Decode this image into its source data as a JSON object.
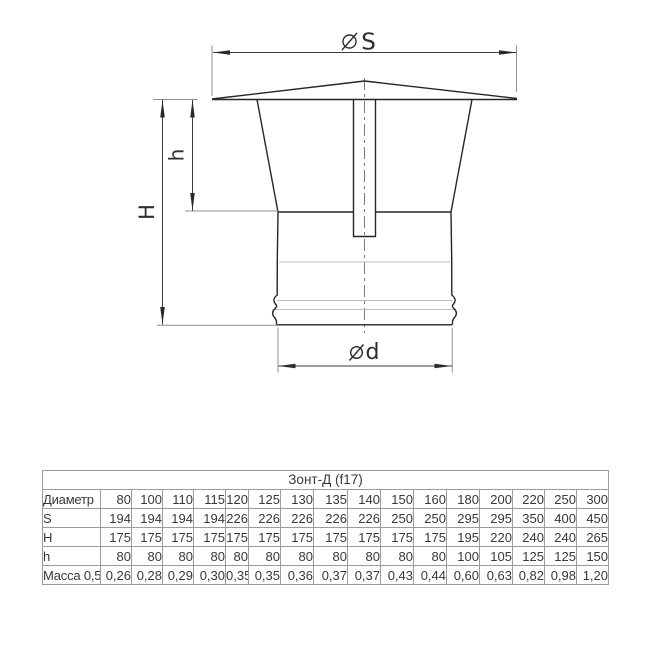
{
  "diagram": {
    "labels": {
      "top_diameter": "S",
      "bottom_diameter": "d",
      "total_height": "H",
      "cone_height": "h"
    },
    "symbols": {
      "diameter": "⌀"
    },
    "colors": {
      "part_line": "#262626",
      "dimension_line": "#3c3c3c",
      "extension_line": "#8f8f8f",
      "seam_line": "#bcbcbc",
      "centerline": "#7a7a7a"
    }
  },
  "table": {
    "title": "Зонт-Д (f17)",
    "rows": [
      {
        "label": "Диаметр",
        "values": [
          "80",
          "100",
          "110",
          "115",
          "120",
          "125",
          "130",
          "135",
          "140",
          "150",
          "160",
          "180",
          "200",
          "220",
          "250",
          "300"
        ]
      },
      {
        "label": "S",
        "values": [
          "194",
          "194",
          "194",
          "194",
          "226",
          "226",
          "226",
          "226",
          "226",
          "250",
          "250",
          "295",
          "295",
          "350",
          "400",
          "450"
        ]
      },
      {
        "label": "H",
        "values": [
          "175",
          "175",
          "175",
          "175",
          "175",
          "175",
          "175",
          "175",
          "175",
          "175",
          "175",
          "195",
          "220",
          "240",
          "240",
          "265"
        ]
      },
      {
        "label": "h",
        "values": [
          "80",
          "80",
          "80",
          "80",
          "80",
          "80",
          "80",
          "80",
          "80",
          "80",
          "80",
          "100",
          "105",
          "125",
          "125",
          "150"
        ]
      },
      {
        "label": "Масса 0,5",
        "values": [
          "0,26",
          "0,28",
          "0,29",
          "0,30",
          "0,35",
          "0,35",
          "0,36",
          "0,37",
          "0,37",
          "0,43",
          "0,44",
          "0,60",
          "0,63",
          "0,82",
          "0,98",
          "1,20"
        ]
      }
    ],
    "border_color": "#9c9c9c",
    "text_color": "#383838"
  }
}
